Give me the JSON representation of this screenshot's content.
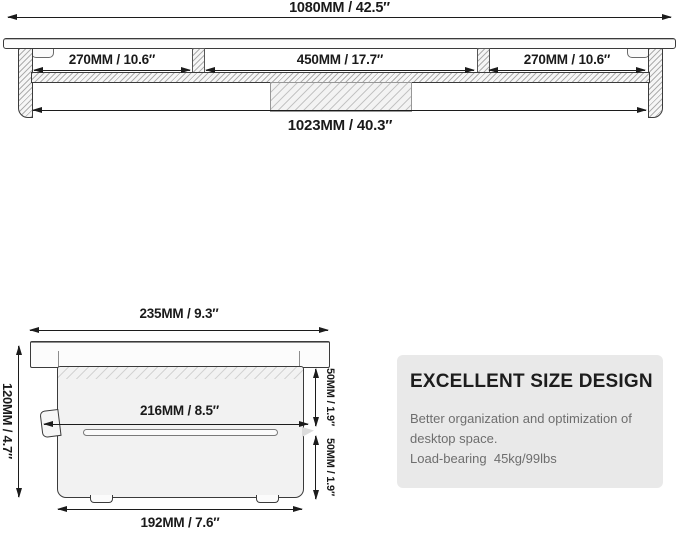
{
  "front_view": {
    "overall_width_label": "1080MM / 42.5″",
    "left_section_label": "270MM / 10.6″",
    "center_section_label": "450MM / 17.7″",
    "right_section_label": "270MM / 10.6″",
    "inner_width_label": "1023MM / 40.3″"
  },
  "side_view": {
    "top_depth_label": "235MM / 9.3″",
    "height_label": "120MM / 4.7″",
    "middle_depth_label": "216MM / 8.5″",
    "upper_gap_label": "50MM / 1.9″",
    "lower_gap_label": "50MM / 1.9″",
    "base_depth_label": "192MM / 7.6″"
  },
  "info_card": {
    "title": "EXCELLENT SIZE DESIGN",
    "lines": [
      "Better organization and optimization of",
      "desktop space.",
      "Load-bearing  45kg/99lbs"
    ],
    "background": "#e9e9e9"
  },
  "colors": {
    "line": "#3b3b3b",
    "arrow": "#1c1c1c",
    "dimension_text": "#1a1a1a",
    "card_body_text": "#6e6e6e"
  }
}
